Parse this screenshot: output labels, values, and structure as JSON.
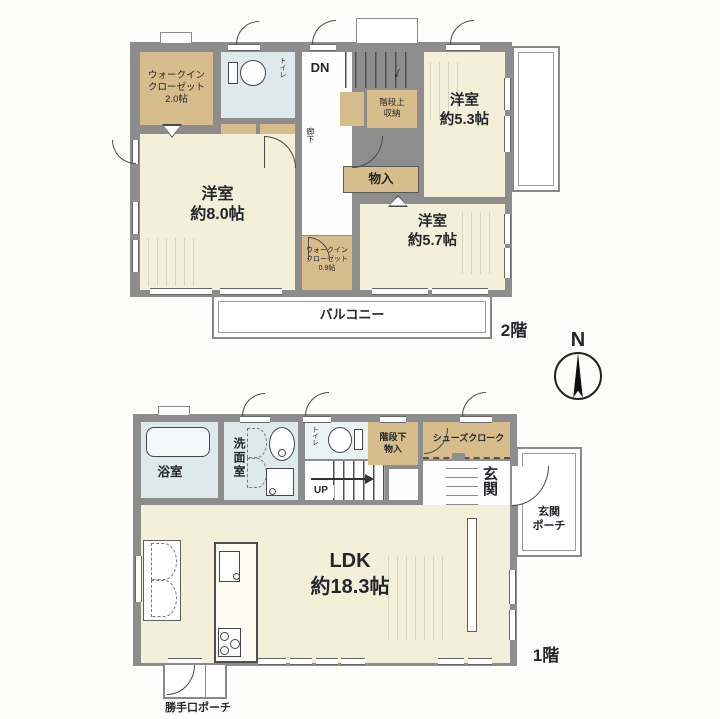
{
  "compass": {
    "north_label": "N"
  },
  "floor2": {
    "floor_label": "2階",
    "rooms": {
      "walkin_closet_20": "ウォークイン\nクローゼット\n2.0帖",
      "toilet": "トイレ",
      "closet_left_a": "物入",
      "closet_left_b": "物入",
      "stairs_dn": "DN",
      "hallway": "廊下",
      "stair_top_storage": "階段上\n収納",
      "bedroom_53": "洋室\n約5.3帖",
      "closet_center": "物入",
      "bedroom_80": "洋室\n約8.0帖",
      "walkin_closet_09": "ウォークイン\nクローゼット\n0.9帖",
      "bedroom_57": "洋室\n約5.7帖",
      "balcony": "バルコニー"
    }
  },
  "floor1": {
    "floor_label": "1階",
    "rooms": {
      "bathroom": "浴室",
      "washroom": "洗面室",
      "toilet": "トイレ",
      "stairs_up": "UP",
      "under_stair_storage": "階段下\n物入",
      "shoes_cloak": "シューズクローク",
      "entrance": "玄関",
      "entrance_porch": "玄関\nポーチ",
      "ldk": "LDK\n約18.3帖",
      "back_door_porch": "勝手口ポーチ"
    }
  },
  "colors": {
    "wall": "#8d8d8d",
    "room_floor": "#f4efd9",
    "storage": "#d7bc8c",
    "wet_area": "#dde9ea",
    "outline": "#4a4a4a"
  }
}
